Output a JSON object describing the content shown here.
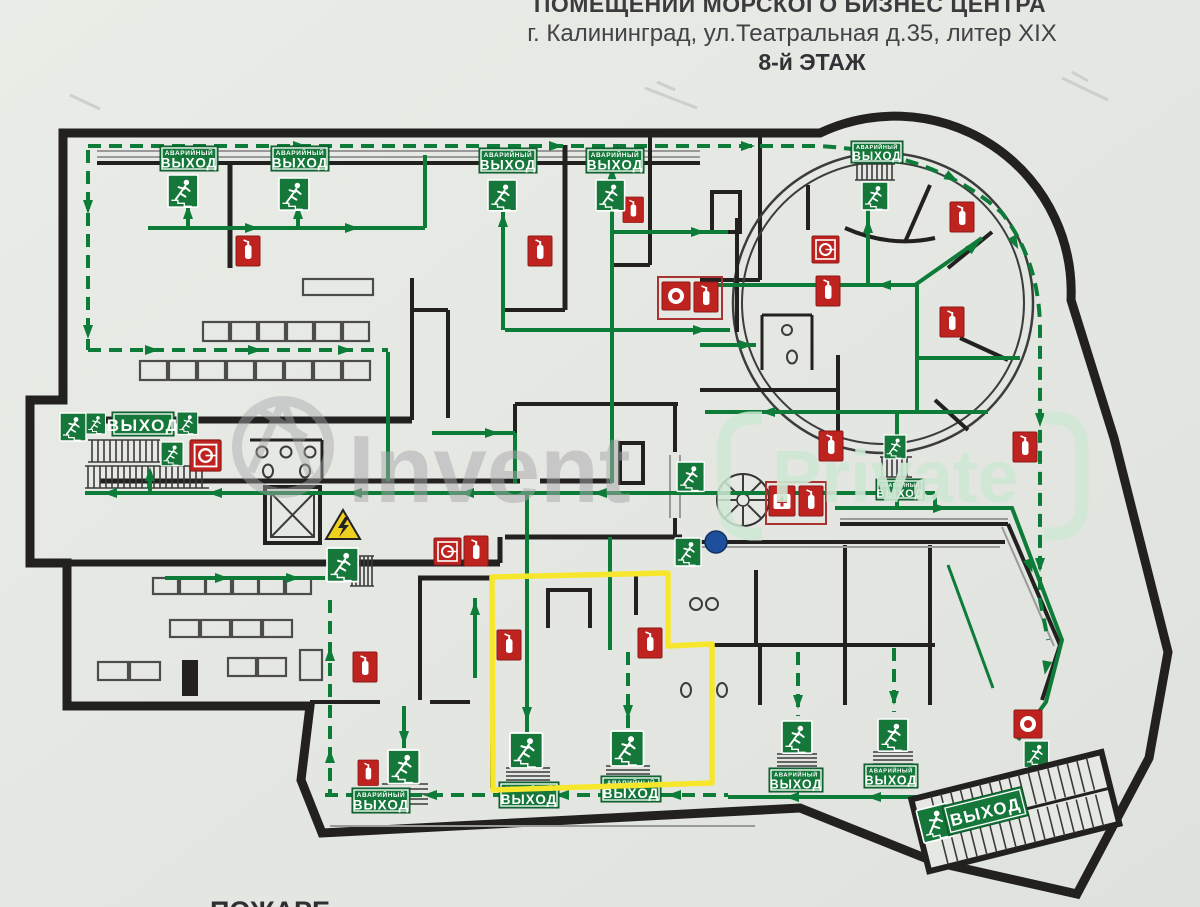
{
  "header": {
    "line1": "ПОМЕЩЕНИЙ МОРСКОГО БИЗНЕС ЦЕНТРА",
    "line2": "г. Калининград, ул.Театральная д.35, литер XIX",
    "line3": "8-й ЭТАЖ"
  },
  "labels": {
    "emergency": "АВАРИЙНЫЙ",
    "exit": "ВЫХОД"
  },
  "watermark": {
    "word1": "Invent",
    "word2": "Private"
  },
  "footer": {
    "fragment": "ПОЖАРЕ"
  },
  "icons": {
    "running_man": "running-man-icon",
    "fire_extinguisher": "fire-extinguisher-icon",
    "fire_hose_reel": "fire-hose-reel-icon",
    "manual_call_point": "manual-call-point-icon",
    "first_aid_kit": "first-aid-kit-icon",
    "electrical_hazard": "electrical-hazard-icon",
    "elevator": "elevator-shaft",
    "spiral_stairs": "spiral-staircase",
    "hydrant": "hydrant-marker"
  },
  "colors": {
    "paper": "#e6e8e3",
    "wall": "#232120",
    "route_green": "#0e7c39",
    "sign_green": "#15773a",
    "alarm_red": "#bf2320",
    "highlight_yellow": "#f7e72c",
    "hydrant_blue": "#1d4f9c",
    "watermark_gray": "#a8a8ab",
    "watermark_green": "#cfe8d4"
  }
}
